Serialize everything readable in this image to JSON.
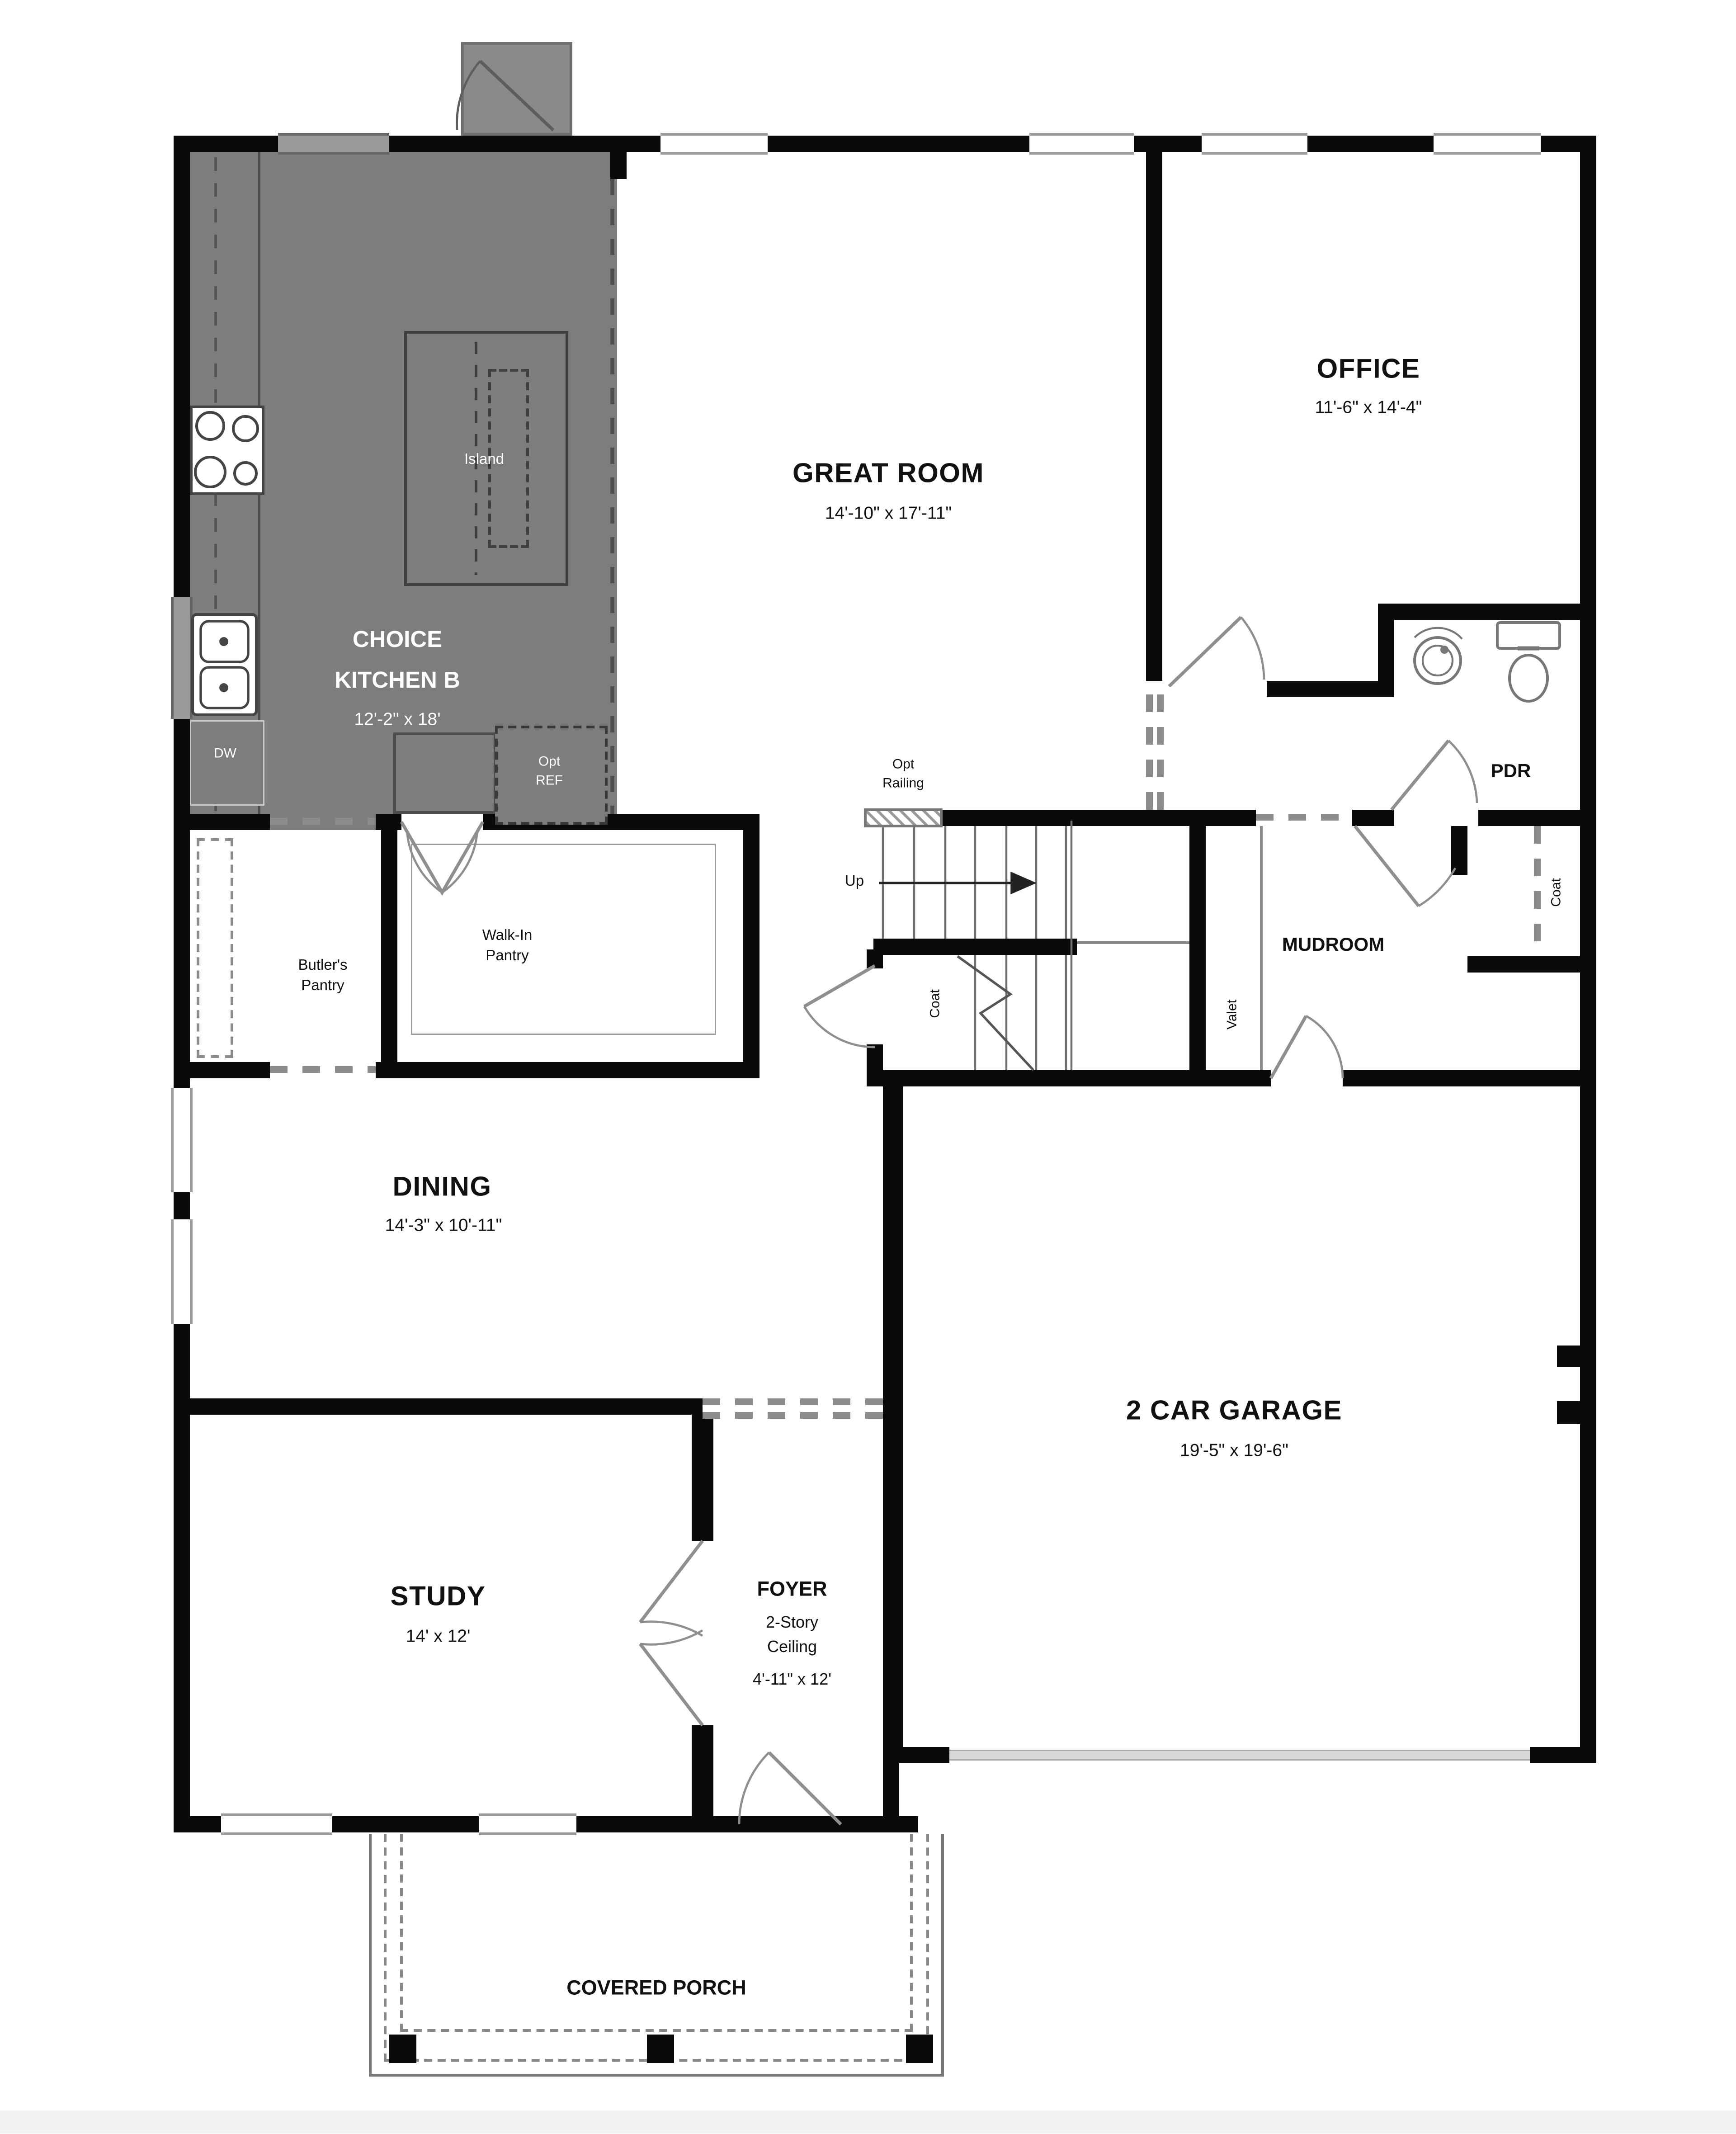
{
  "rooms": {
    "kitchen": {
      "name1": "CHOICE",
      "name2": "KITCHEN B",
      "dims": "12'-2\" x 18'"
    },
    "great_room": {
      "name": "GREAT ROOM",
      "dims": "14'-10\" x 17'-11\""
    },
    "office": {
      "name": "OFFICE",
      "dims": "11'-6\" x 14'-4\""
    },
    "dining": {
      "name": "DINING",
      "dims": "14'-3\" x 10'-11\""
    },
    "study": {
      "name": "STUDY",
      "dims": "14' x 12'"
    },
    "foyer": {
      "name": "FOYER",
      "line2": "2-Story",
      "line3": "Ceiling",
      "dims": "4'-11\" x 12'"
    },
    "garage": {
      "name": "2 CAR GARAGE",
      "dims": "19'-5\" x 19'-6\""
    },
    "mudroom": {
      "name": "MUDROOM"
    },
    "pdr": {
      "name": "PDR"
    },
    "porch": {
      "name": "COVERED PORCH"
    },
    "butlers_pantry": {
      "line1": "Butler's",
      "line2": "Pantry"
    },
    "walkin_pantry": {
      "line1": "Walk-In",
      "line2": "Pantry"
    }
  },
  "labels": {
    "island": "Island",
    "dw": "DW",
    "opt_ref_1": "Opt",
    "opt_ref_2": "REF",
    "opt_railing_1": "Opt",
    "opt_railing_2": "Railing",
    "up": "Up",
    "coat_under_stairs": "Coat",
    "valet": "Valet",
    "coat_closet": "Coat"
  },
  "colors": {
    "wall": "#0a0a0a",
    "kitchen_fill": "#7d7d7d",
    "chimney_fill": "#8a8a8a",
    "dash_gray": "#8c8c8c",
    "garage_door": "#d8d8d8",
    "bottom_strip": "#f1f1f1"
  }
}
